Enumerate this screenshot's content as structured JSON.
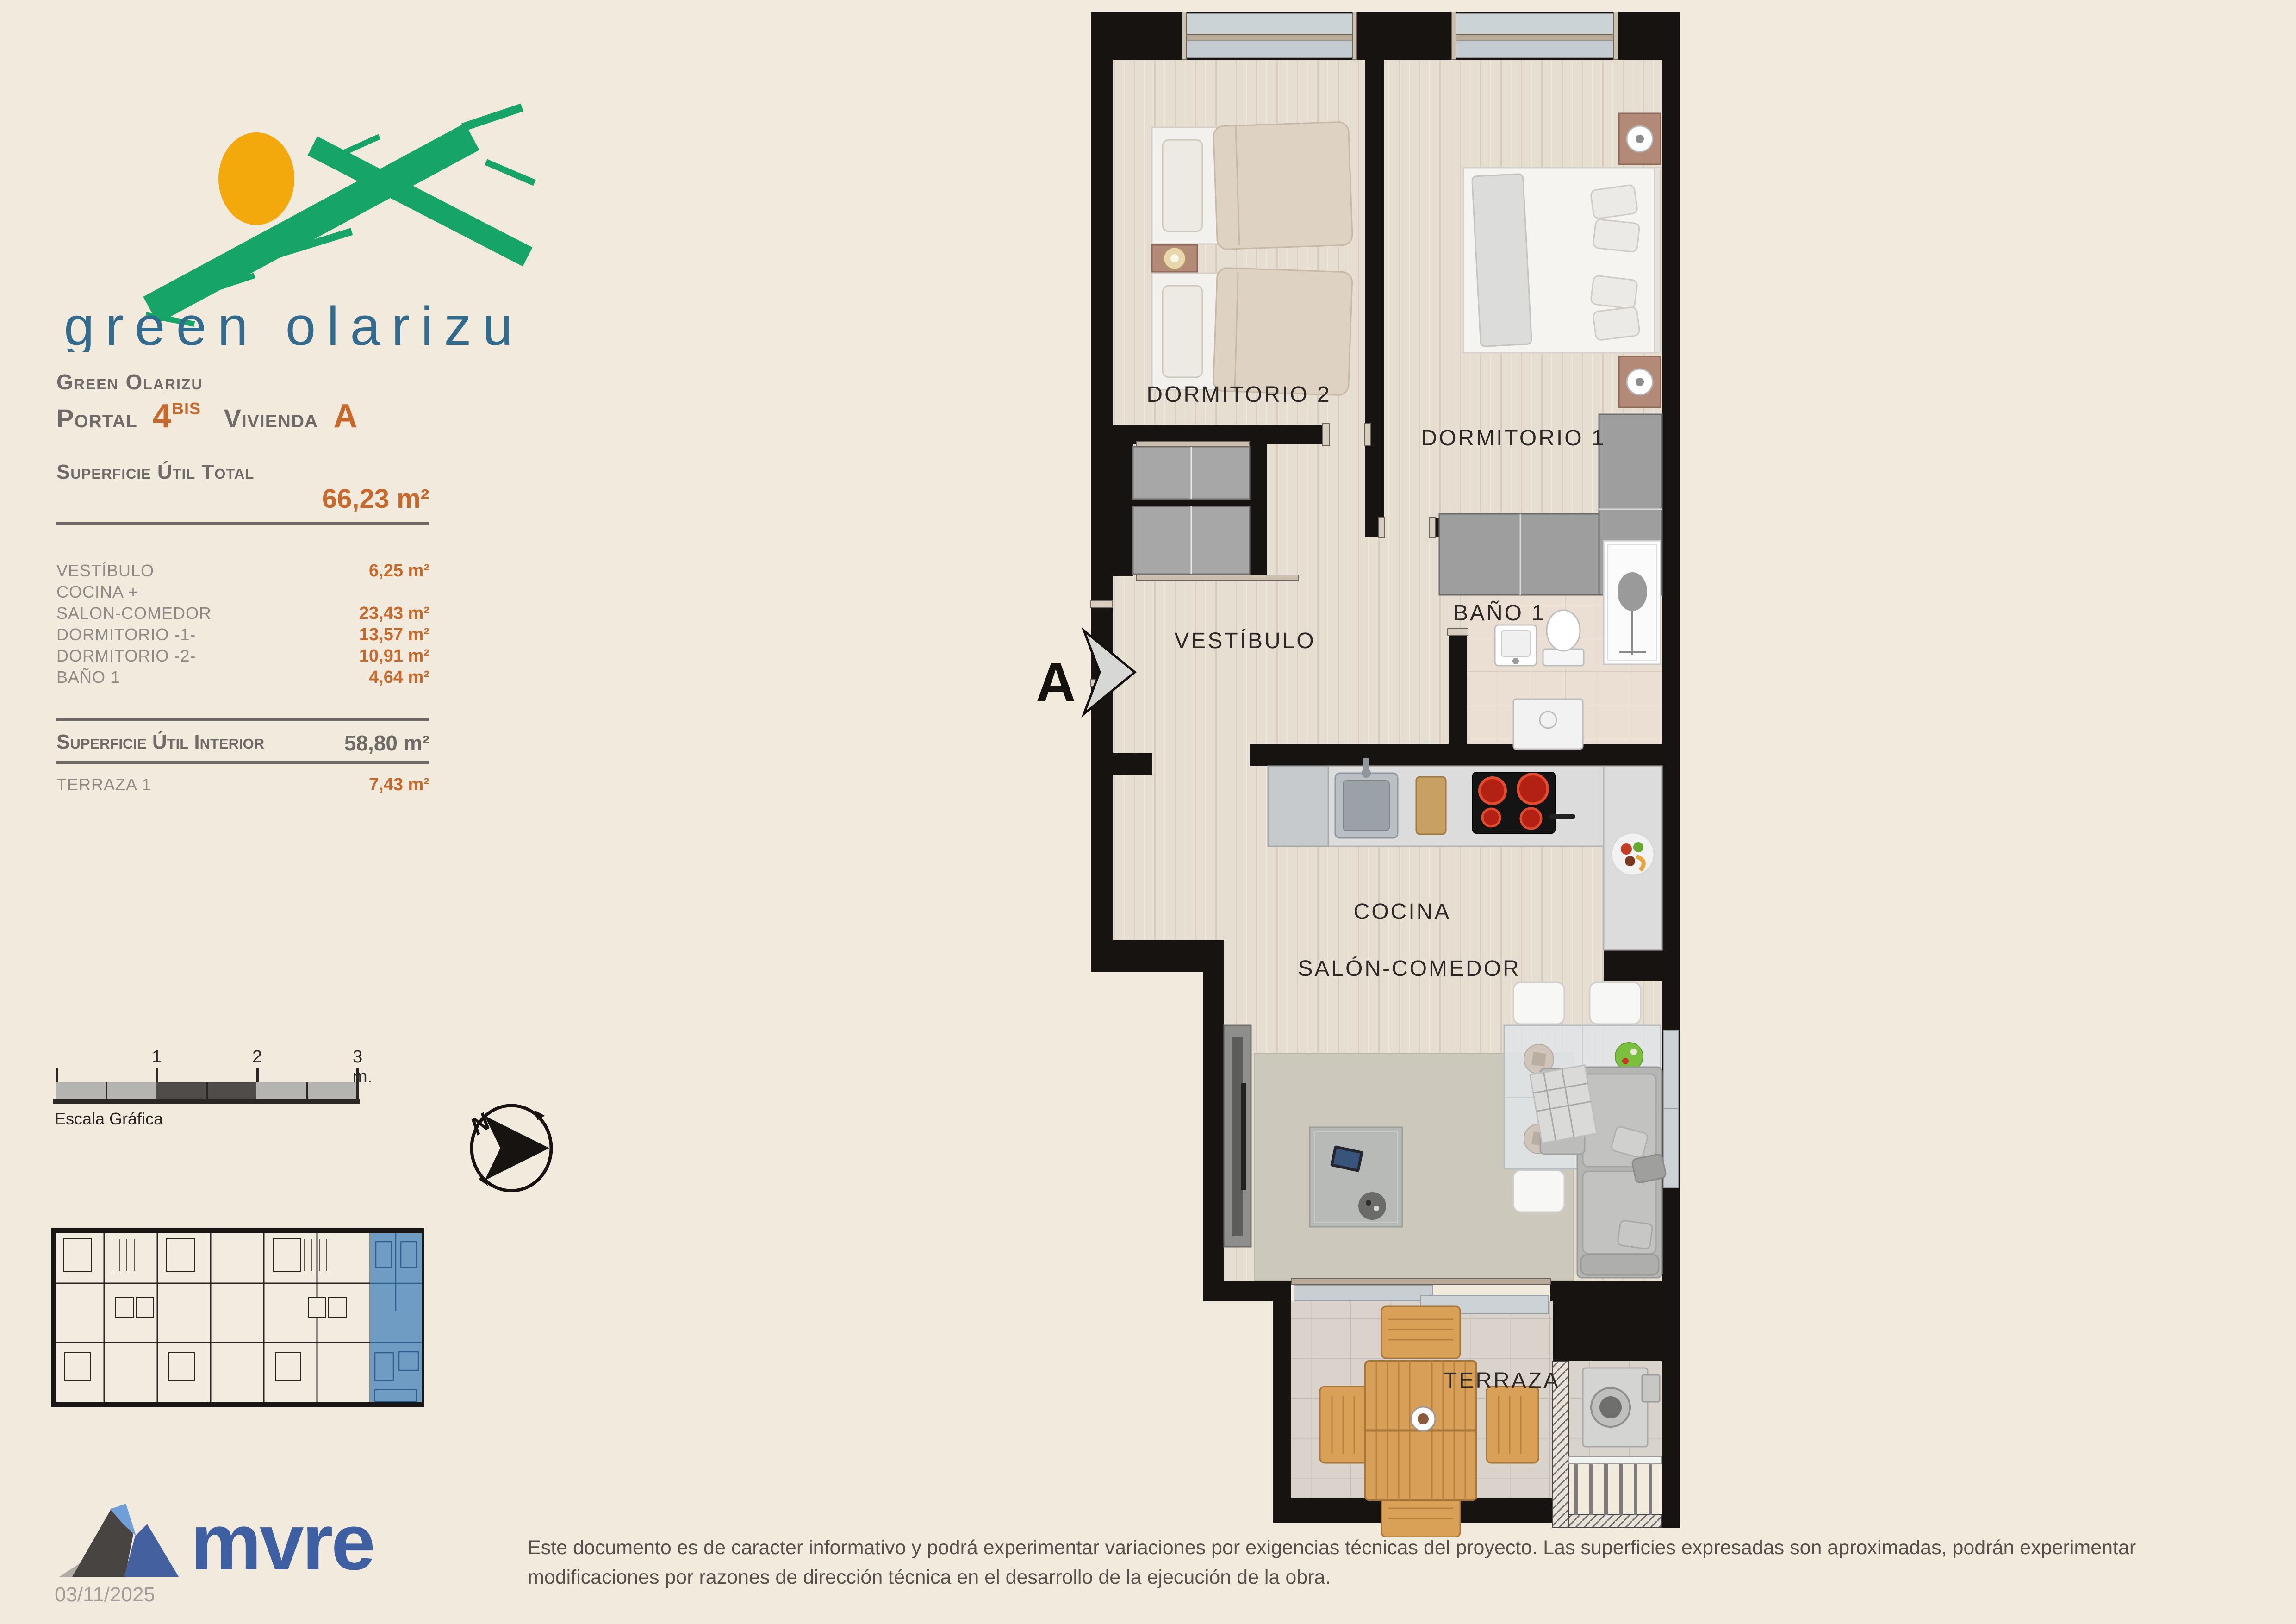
{
  "logo": {
    "name_text": "green olarizu"
  },
  "header": {
    "project": "Green Olarizu",
    "portal_label": "Portal",
    "portal_number": "4",
    "portal_sup": "BIS",
    "vivienda_label": "Vivienda",
    "vivienda_letter": "A"
  },
  "surface": {
    "total_label": "Superficie Útil Total",
    "total_value": "66,23 m²",
    "rows": [
      {
        "label": "VESTÍBULO",
        "value": "6,25 m²"
      },
      {
        "label": "COCINA +",
        "value": ""
      },
      {
        "label": "SALON-COMEDOR",
        "value": "23,43 m²"
      },
      {
        "label": "DORMITORIO -1-",
        "value": "13,57 m²"
      },
      {
        "label": "DORMITORIO -2-",
        "value": "10,91 m²"
      },
      {
        "label": "BAÑO 1",
        "value": "4,64 m²"
      }
    ],
    "interior_label": "Superficie Útil Interior",
    "interior_value": "58,80 m²",
    "terrace_label": "TERRAZA 1",
    "terrace_value": "7,43 m²"
  },
  "scalebar": {
    "caption": "Escala Gráfica",
    "tick1": "1",
    "tick2": "2",
    "tick3": "3 m."
  },
  "compass": {
    "north": "N"
  },
  "plan": {
    "section_marker": "A",
    "rooms": {
      "dorm2": "DORMITORIO 2",
      "dorm1": "DORMITORIO 1",
      "vestibulo": "VESTÍBULO",
      "bano": "BAÑO 1",
      "cocina": "COCINA",
      "salon": "SALÓN-COMEDOR",
      "terraza": "TERRAZA"
    }
  },
  "footer": {
    "brand": "mvre",
    "date": "03/11/2025",
    "disclaimer": "Este documento es de caracter informativo y podrá experimentar variaciones por exigencias técnicas del proyecto. Las superficies expresadas son aproximadas, podrán experimentar modificaciones por razones de dirección técnica en el desarrollo de la ejecución de la obra."
  },
  "colors": {
    "accent_orange": "#c8692b",
    "heading_gray": "#6f6b68",
    "logo_green": "#17a468",
    "logo_sun": "#f3a90c",
    "logo_blue": "#336b8e",
    "mvre_blue": "#3e5fa2",
    "unit_highlight": "#6e9cc3"
  }
}
